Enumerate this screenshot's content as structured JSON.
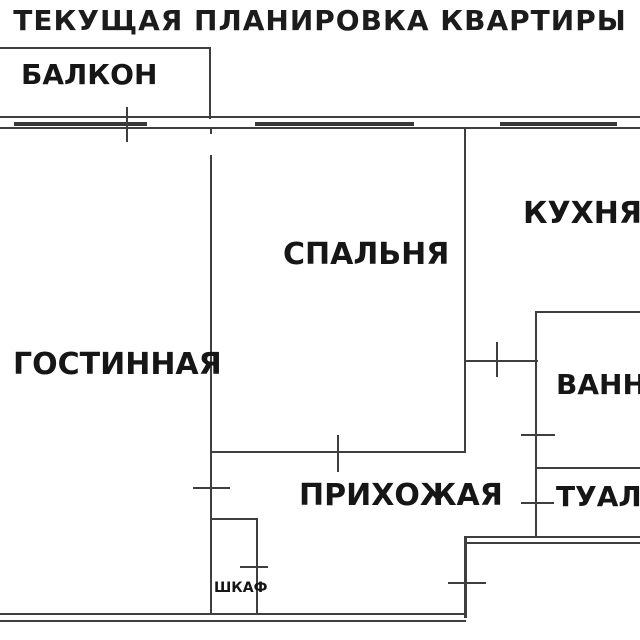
{
  "title": "ТЕКУЩАЯ ПЛАНИРОВКА КВАРТИРЫ",
  "canvas": {
    "width": 640,
    "height": 640,
    "background_color": "#ffffff",
    "wall_color": "#3f3f3f",
    "text_color": "#161616"
  },
  "rooms": [
    {
      "id": "balcony",
      "label": "БАЛКОН",
      "x": 21,
      "y": 61,
      "font_size": 28
    },
    {
      "id": "living-room",
      "label": "ГОСТИННАЯ",
      "x": 13,
      "y": 350,
      "font_size": 30
    },
    {
      "id": "bedroom",
      "label": "СПАЛЬНЯ",
      "x": 283,
      "y": 240,
      "font_size": 30
    },
    {
      "id": "kitchen",
      "label": "КУХНЯ",
      "x": 523,
      "y": 199,
      "font_size": 30
    },
    {
      "id": "hallway",
      "label": "ПРИХОЖАЯ",
      "x": 299,
      "y": 481,
      "font_size": 30
    },
    {
      "id": "bathroom",
      "label": "ВАННАЯ",
      "x": 556,
      "y": 371,
      "font_size": 28
    },
    {
      "id": "toilet",
      "label": "ТУАЛЕТ",
      "x": 556,
      "y": 483,
      "font_size": 28
    },
    {
      "id": "closet",
      "label": "ШКАФ",
      "x": 214,
      "y": 581,
      "font_size": 14
    }
  ],
  "walls": [
    {
      "name": "top-exterior-wall-outer-line",
      "x": 0,
      "y": 116,
      "w": 640,
      "h": 2
    },
    {
      "name": "top-exterior-wall-inner-line",
      "x": 0,
      "y": 127,
      "w": 640,
      "h": 2
    },
    {
      "name": "balcony-top-wall",
      "x": 0,
      "y": 47,
      "w": 211,
      "h": 2
    },
    {
      "name": "balcony-right-wall",
      "x": 209,
      "y": 47,
      "w": 2,
      "h": 72
    },
    {
      "name": "living-bedroom-wall-stub",
      "x": 210,
      "y": 129,
      "w": 2,
      "h": 5
    },
    {
      "name": "living-bedroom-wall",
      "x": 210,
      "y": 155,
      "w": 2,
      "h": 298
    },
    {
      "name": "living-hallway-wall",
      "x": 210,
      "y": 453,
      "w": 2,
      "h": 162
    },
    {
      "name": "bedroom-bottom-wall",
      "x": 210,
      "y": 451,
      "w": 256,
      "h": 2
    },
    {
      "name": "bedroom-kitchen-wall",
      "x": 464,
      "y": 129,
      "w": 2,
      "h": 324
    },
    {
      "name": "kitchen-bottom-wall",
      "x": 464,
      "y": 360,
      "w": 74,
      "h": 2
    },
    {
      "name": "bathroom-top-wall",
      "x": 535,
      "y": 311,
      "w": 105,
      "h": 2
    },
    {
      "name": "bathroom-left-wall",
      "x": 535,
      "y": 311,
      "w": 2,
      "h": 227
    },
    {
      "name": "bathroom-toilet-divider-wall",
      "x": 537,
      "y": 467,
      "w": 103,
      "h": 2
    },
    {
      "name": "toilet-bottom-wall-outer-line",
      "x": 464,
      "y": 536,
      "w": 176,
      "h": 2
    },
    {
      "name": "toilet-bottom-wall-inner-line",
      "x": 464,
      "y": 542,
      "w": 176,
      "h": 2
    },
    {
      "name": "entry-right-wall",
      "x": 464,
      "y": 536,
      "w": 3,
      "h": 82
    },
    {
      "name": "bottom-exterior-wall-outer-line",
      "x": 0,
      "y": 613,
      "w": 467,
      "h": 2
    },
    {
      "name": "bottom-exterior-wall-inner-line",
      "x": 0,
      "y": 620,
      "w": 466,
      "h": 2
    },
    {
      "name": "closet-top-wall",
      "x": 210,
      "y": 518,
      "w": 48,
      "h": 2
    },
    {
      "name": "closet-right-wall",
      "x": 256,
      "y": 518,
      "w": 2,
      "h": 97
    }
  ],
  "windows": [
    {
      "name": "living-room-window",
      "x": 14,
      "y": 122,
      "w": 133,
      "h": 4
    },
    {
      "name": "bedroom-window",
      "x": 255,
      "y": 122,
      "w": 159,
      "h": 4
    },
    {
      "name": "kitchen-window",
      "x": 500,
      "y": 122,
      "w": 117,
      "h": 4
    }
  ],
  "door_ticks": [
    {
      "name": "balcony-door-tick",
      "x": 126,
      "y": 107,
      "w": 2,
      "h": 35
    },
    {
      "name": "bedroom-door-tick",
      "x": 337,
      "y": 435,
      "w": 2,
      "h": 37
    },
    {
      "name": "kitchen-door-tick",
      "x": 496,
      "y": 342,
      "w": 2,
      "h": 35
    },
    {
      "name": "living-room-door-tick",
      "x": 193,
      "y": 487,
      "w": 37,
      "h": 2
    },
    {
      "name": "closet-door-tick",
      "x": 240,
      "y": 566,
      "w": 28,
      "h": 2
    },
    {
      "name": "bathroom-door-tick",
      "x": 521,
      "y": 434,
      "w": 34,
      "h": 2
    },
    {
      "name": "toilet-door-tick",
      "x": 521,
      "y": 502,
      "w": 33,
      "h": 2
    },
    {
      "name": "entry-door-tick",
      "x": 448,
      "y": 582,
      "w": 38,
      "h": 2
    }
  ]
}
